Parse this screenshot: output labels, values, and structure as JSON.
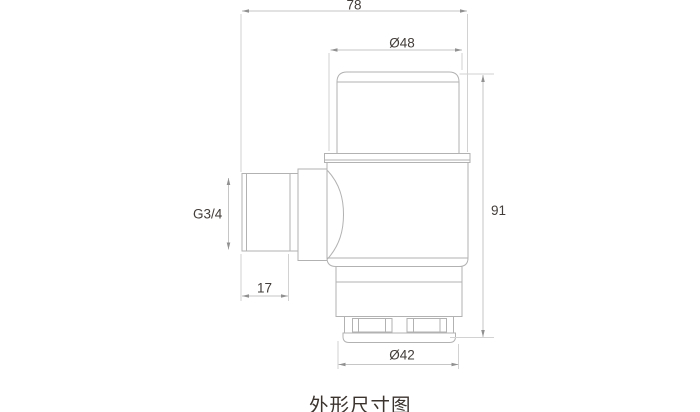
{
  "page": {
    "caption": "外形尺寸图",
    "background": "#ffffff"
  },
  "dimensions": {
    "overall_width": {
      "label": "78"
    },
    "cap_diameter": {
      "label": "Ø48"
    },
    "overall_height": {
      "label": "91"
    },
    "inlet_thread_size": {
      "label": "G3/4"
    },
    "inlet_thread_length": {
      "label": "17"
    },
    "base_diameter": {
      "label": "Ø42"
    }
  },
  "colors": {
    "part_line": "#b2b2b2",
    "dimension_line": "#c6c6c6",
    "extension_line": "#d2d2d2",
    "arrow": "#919191",
    "dimension_text": "#423d3a",
    "caption_text": "#3b332e",
    "background": "#ffffff"
  }
}
